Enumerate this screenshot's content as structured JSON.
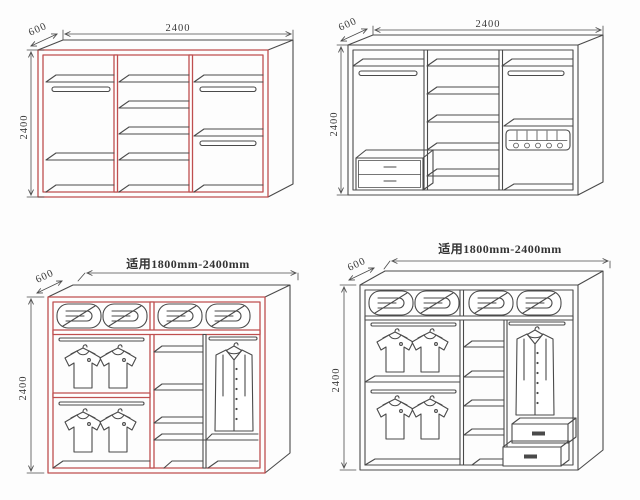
{
  "colors": {
    "accent_red": "#bf4f4f",
    "line_dark": "#4a4a4a",
    "background": "#ffffff"
  },
  "diagrams": {
    "top_left": {
      "width_label": "2400",
      "depth_label": "600",
      "height_label": "2400"
    },
    "top_right": {
      "width_label": "2400",
      "depth_label": "600",
      "height_label": "2400"
    },
    "bottom_left": {
      "range_label": "适用1800mm-2400mm",
      "depth_label": "600",
      "height_label": "2400"
    },
    "bottom_right": {
      "range_label": "适用1800mm-2400mm",
      "depth_label": "600",
      "height_label": "2400"
    }
  }
}
